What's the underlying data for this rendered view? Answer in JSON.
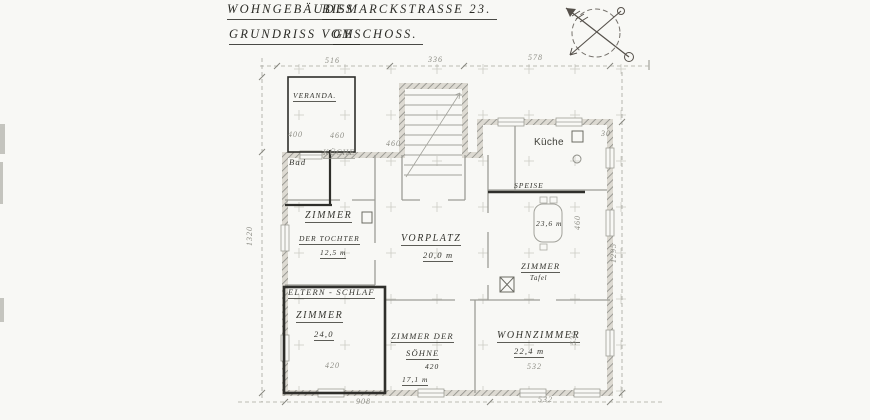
{
  "colors": {
    "paper": "#f8f8f5",
    "faint_line": "#a6a69f",
    "dark_ink": "#2f2f2b"
  },
  "title": {
    "line1_left": "WOHNGEBÄUDES",
    "line1_right": "BISMARCKSTRASSE 23.",
    "line2_left": "GRUNDRISS VOM",
    "line2_right": "GESCHOSS."
  },
  "compass": {
    "icon": "north-arrow-compass"
  },
  "plan": {
    "labels": [
      {
        "id": "veranda",
        "text": "VERANDA.",
        "cls": "hand xs u",
        "x": 293,
        "y": 92
      },
      {
        "id": "dim-516",
        "text": "516",
        "cls": "dim",
        "x": 325,
        "y": 57
      },
      {
        "id": "dim-336",
        "text": "336",
        "cls": "dim",
        "x": 428,
        "y": 56
      },
      {
        "id": "dim-578",
        "text": "578",
        "cls": "dim",
        "x": 528,
        "y": 54
      },
      {
        "id": "dim-1320",
        "text": "1320",
        "cls": "dim vert",
        "x": 246,
        "y": 246
      },
      {
        "id": "dim-1295",
        "text": "1295",
        "cls": "dim vert",
        "x": 610,
        "y": 263
      },
      {
        "id": "dim-30",
        "text": "30",
        "cls": "dim",
        "x": 601,
        "y": 130
      },
      {
        "id": "dim-908",
        "text": "908",
        "cls": "dim",
        "x": 356,
        "y": 398
      },
      {
        "id": "dim-532-bottom",
        "text": "532",
        "cls": "dim",
        "x": 538,
        "y": 396
      },
      {
        "id": "kueche",
        "text": "Küche",
        "cls": "typed",
        "x": 534,
        "y": 138
      },
      {
        "id": "kueche-faint",
        "text": "KÜCHE",
        "cls": "dim tiny u",
        "x": 323,
        "y": 149
      },
      {
        "id": "bad",
        "text": "Bad",
        "cls": "hand sm",
        "x": 289,
        "y": 158
      },
      {
        "id": "zimmer-tochter",
        "text": "ZIMMER",
        "cls": "hand u",
        "x": 305,
        "y": 211
      },
      {
        "id": "der-tochter",
        "text": "DER TOCHTER",
        "cls": "hand xs u",
        "x": 299,
        "y": 235
      },
      {
        "id": "area-tochter",
        "text": "12,5 m",
        "cls": "hand xs u",
        "x": 320,
        "y": 249
      },
      {
        "id": "vorplatz",
        "text": "VORPLATZ",
        "cls": "hand u",
        "x": 401,
        "y": 234
      },
      {
        "id": "area-vorplatz",
        "text": "20,0 m",
        "cls": "hand sm u",
        "x": 423,
        "y": 251
      },
      {
        "id": "speise",
        "text": "SPEISE",
        "cls": "hand xs u",
        "x": 514,
        "y": 182
      },
      {
        "id": "area-speise",
        "text": "23,6 m",
        "cls": "hand xs",
        "x": 536,
        "y": 220
      },
      {
        "id": "zimmer-speise",
        "text": "ZIMMER",
        "cls": "hand sm u",
        "x": 521,
        "y": 262
      },
      {
        "id": "tafel",
        "text": "Tafel",
        "cls": "hand tiny",
        "x": 530,
        "y": 276
      },
      {
        "id": "eltern-schlaf",
        "text": "ELTERN - SCHLAF",
        "cls": "hand sm u",
        "x": 288,
        "y": 288
      },
      {
        "id": "zimmer-eltern",
        "text": "ZIMMER",
        "cls": "hand u",
        "x": 296,
        "y": 311
      },
      {
        "id": "area-eltern",
        "text": "24,0",
        "cls": "hand sm u",
        "x": 314,
        "y": 330
      },
      {
        "id": "dim-420-eltern",
        "text": "420",
        "cls": "dim",
        "x": 325,
        "y": 362
      },
      {
        "id": "zimmer-der",
        "text": "ZIMMER DER",
        "cls": "hand sm u",
        "x": 391,
        "y": 332
      },
      {
        "id": "soehne",
        "text": "SÖHNE",
        "cls": "hand sm u",
        "x": 406,
        "y": 349
      },
      {
        "id": "dim-420-soehne",
        "text": "420",
        "cls": "hand xs",
        "x": 425,
        "y": 363
      },
      {
        "id": "area-soehne",
        "text": "17,1 m",
        "cls": "hand xs u",
        "x": 402,
        "y": 376
      },
      {
        "id": "wohnzimmer",
        "text": "WOHNZIMMER",
        "cls": "hand u",
        "x": 497,
        "y": 331
      },
      {
        "id": "area-wohnzimmer",
        "text": "22,4 m",
        "cls": "hand sm u",
        "x": 514,
        "y": 347
      },
      {
        "id": "dim-532-wohn",
        "text": "532",
        "cls": "dim",
        "x": 527,
        "y": 363
      },
      {
        "id": "dim-535",
        "text": "535",
        "cls": "dim vert",
        "x": 570,
        "y": 345
      },
      {
        "id": "dim-460-speise",
        "text": "460",
        "cls": "dim vert",
        "x": 574,
        "y": 230
      },
      {
        "id": "dim-400",
        "text": "400",
        "cls": "dim",
        "x": 288,
        "y": 131
      },
      {
        "id": "dim-460",
        "text": "460",
        "cls": "dim",
        "x": 330,
        "y": 132
      },
      {
        "id": "dim-460b",
        "text": "460",
        "cls": "dim",
        "x": 386,
        "y": 140
      }
    ]
  }
}
